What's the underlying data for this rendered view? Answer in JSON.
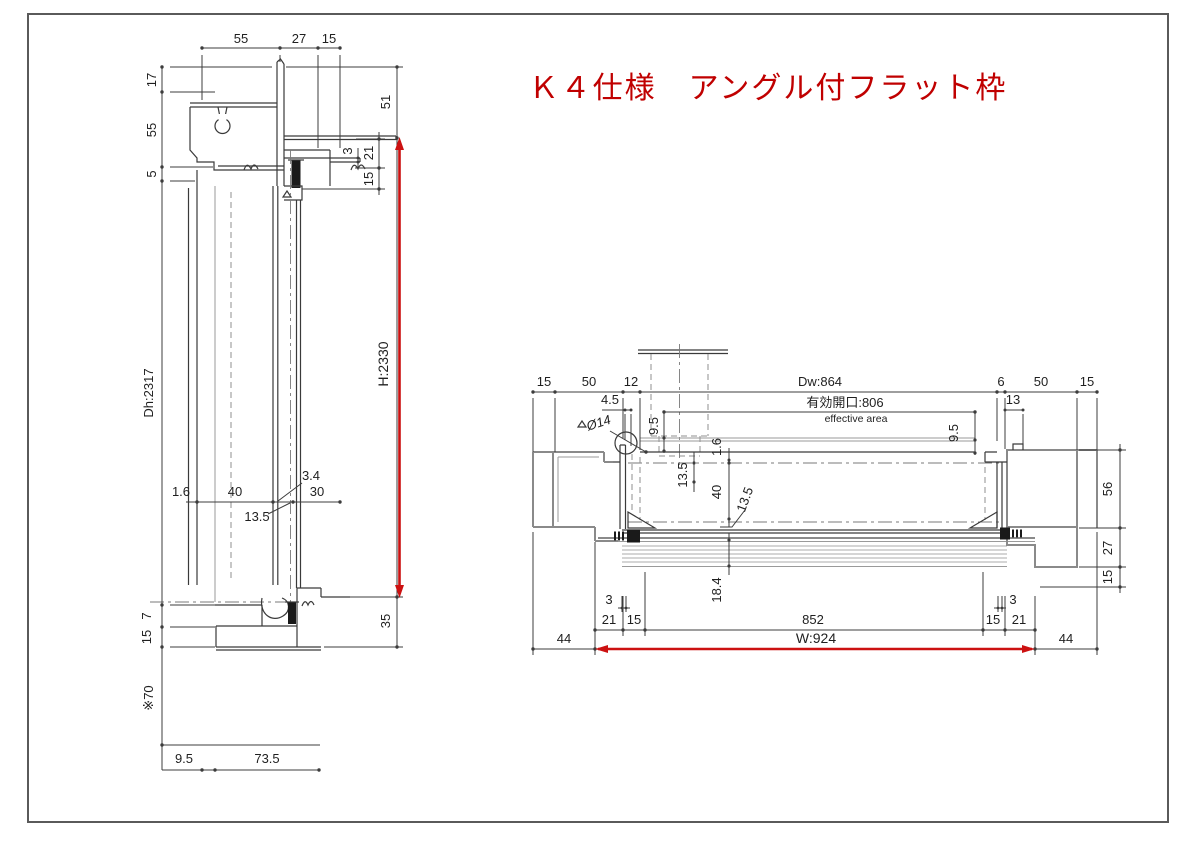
{
  "title": {
    "text": "Ｋ４仕様　アングル付フラット枠",
    "color": "#c00000"
  },
  "colors": {
    "background": "#ffffff",
    "border": "#5a5a5a",
    "line": "#3c3c3c",
    "profile_gray": "#8a8a8a",
    "accent_red": "#cc1111",
    "title_red": "#c00000"
  },
  "left_view": {
    "description": "vertical-section",
    "top": {
      "d55": "55",
      "d27": "27",
      "d15": "15"
    },
    "left": {
      "d17": "17",
      "d55": "55",
      "d5": "5",
      "dh2317": "Dh:2317",
      "d7": "7",
      "d15": "15",
      "d70": "※70"
    },
    "mid": {
      "d1_6": "1.6",
      "d40": "40",
      "d3_4": "3.4",
      "d30": "30",
      "d13_5": "13.5"
    },
    "right": {
      "d51": "51",
      "d3": "3",
      "d21": "21",
      "d15": "15",
      "h2330": "H:2330",
      "d35": "35"
    },
    "bottom": {
      "d9_5": "9.5",
      "d73_5": "73.5"
    }
  },
  "right_view": {
    "description": "horizontal-section",
    "top": {
      "d15_left": "15",
      "d50_left": "50",
      "d12": "12",
      "dw864": "Dw:864",
      "opening_jp": "有効開口:806",
      "opening_en": "effective area",
      "d4_5": "4.5",
      "dia14": "Ø14",
      "d6": "6",
      "d50_right": "50",
      "d15_right": "15",
      "d13": "13"
    },
    "mid": {
      "d9_5_left": "9.5",
      "d1_6": "1.6",
      "d13_5_upper": "13.5",
      "d40": "40",
      "d13_5_lower": "13.5",
      "d9_5_right": "9.5",
      "d18_4": "18.4"
    },
    "right": {
      "d56": "56",
      "d27": "27",
      "d15": "15"
    },
    "bottom": {
      "d3_left": "3",
      "d21_left": "21",
      "d15_left": "15",
      "d852": "852",
      "d15_right": "15",
      "d21_right": "21",
      "d3_right": "3",
      "w924": "W:924",
      "d44_left": "44",
      "d44_right": "44"
    }
  }
}
